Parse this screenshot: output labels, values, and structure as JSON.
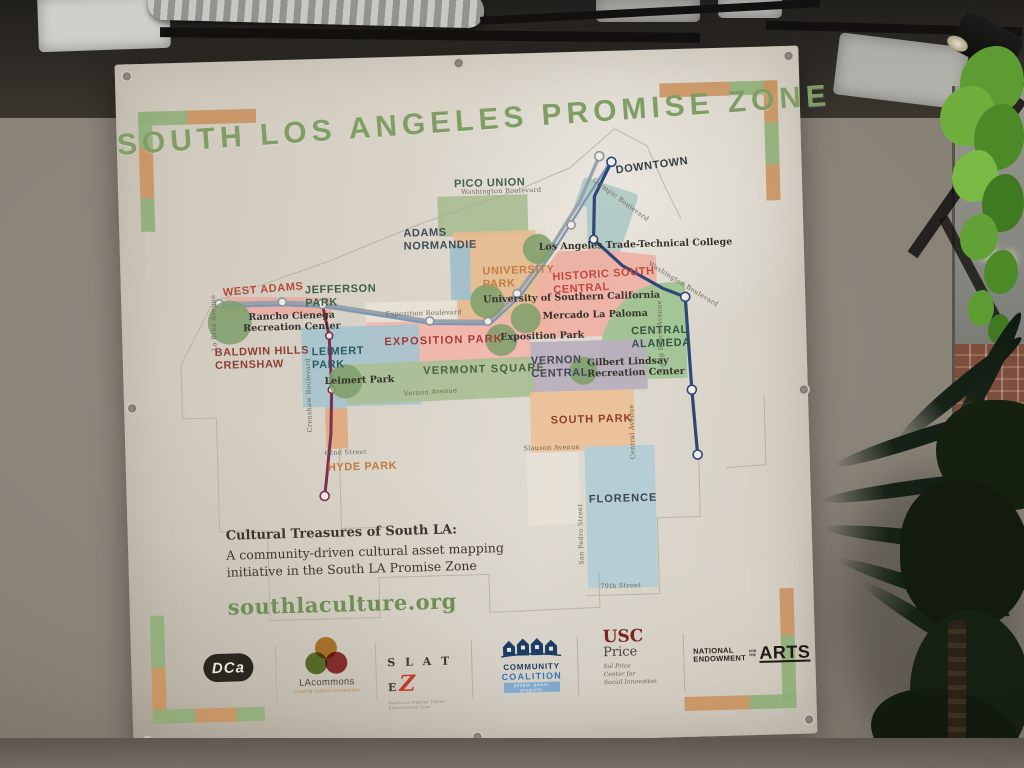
{
  "banner": {
    "title": "SOUTH LOS ANGELES PROMISE ZONE",
    "footer": {
      "heading": "Cultural Treasures of South LA:",
      "line1": "A community-driven cultural asset mapping",
      "line2": "initiative in the South LA Promise Zone",
      "website": "southlaculture.org"
    },
    "logos": {
      "dca": "DCa",
      "lacommons_name": "LAcommons",
      "lacommons_tagline": "creating cultural connections",
      "slatez_name": "S L A T E",
      "slatez_z": "Z",
      "slatez_tagline": "South Los Angeles Transit Empowerment Zone",
      "cc_line1": "COMMUNITY",
      "cc_line2": "COALITION",
      "cc_tagline": "people. power. progress.",
      "usc_top": "USC",
      "usc_bottom": "Price",
      "usc_sub1": "Sol Price",
      "usc_sub2": "Center for",
      "usc_sub3": "Social Innovation",
      "nea_line1": "NATIONAL",
      "nea_line2": "ENDOWMENT",
      "nea_for1": "FOR",
      "nea_for2": "THE",
      "nea_arts": "ARTS"
    }
  },
  "map": {
    "neighborhoods": [
      {
        "name": "PICO UNION",
        "color": "#44604a"
      },
      {
        "name": "ADAMS NORMANDIE",
        "color": "#3e4d58"
      },
      {
        "name": "DOWNTOWN",
        "color": "#333e46"
      },
      {
        "name": "WEST ADAMS",
        "color": "#b5493c"
      },
      {
        "name": "JEFFERSON PARK",
        "color": "#3f5f45"
      },
      {
        "name": "BALDWIN HILLS CRENSHAW",
        "color": "#8e3f35"
      },
      {
        "name": "LEIMERT PARK",
        "color": "#2e5a62"
      },
      {
        "name": "UNIVERSITY PARK",
        "color": "#c07f45"
      },
      {
        "name": "HISTORIC SOUTH CENTRAL",
        "color": "#c2473e"
      },
      {
        "name": "CENTRAL ALAMEDA",
        "color": "#32563f"
      },
      {
        "name": "VERNON CENTRAL",
        "color": "#43465a"
      },
      {
        "name": "EXPOSITION PARK",
        "color": "#a53a33"
      },
      {
        "name": "VERMONT SQUARE",
        "color": "#46623b"
      },
      {
        "name": "SOUTH PARK",
        "color": "#8f3e2a"
      },
      {
        "name": "FLORENCE",
        "color": "#3a4550"
      },
      {
        "name": "HYDE PARK",
        "color": "#c3793d"
      }
    ],
    "streets": [
      {
        "name": "Washington Boulevard"
      },
      {
        "name": "Olympic Boulevard"
      },
      {
        "name": "Washington Boulevard"
      },
      {
        "name": "Long Beach Avenue"
      },
      {
        "name": "Exposition Boulevard"
      },
      {
        "name": "La Brea Avenue"
      },
      {
        "name": "Crenshaw Boulevard"
      },
      {
        "name": "Vernon Avenue"
      },
      {
        "name": "Central Avenue"
      },
      {
        "name": "Slauson Avenue"
      },
      {
        "name": "San Pedro Street"
      },
      {
        "name": "79th Street"
      },
      {
        "name": "62nd Street"
      }
    ],
    "landmarks": [
      {
        "name": "Rancho Cienega Recreation Center"
      },
      {
        "name": "Leimert Park"
      },
      {
        "name": "University of Southern California"
      },
      {
        "name": "Mercado La Paloma"
      },
      {
        "name": "Exposition Park"
      },
      {
        "name": "Los Angeles Trade-Technical College"
      },
      {
        "name": "Gilbert Lindsay Recreation Center"
      }
    ]
  }
}
